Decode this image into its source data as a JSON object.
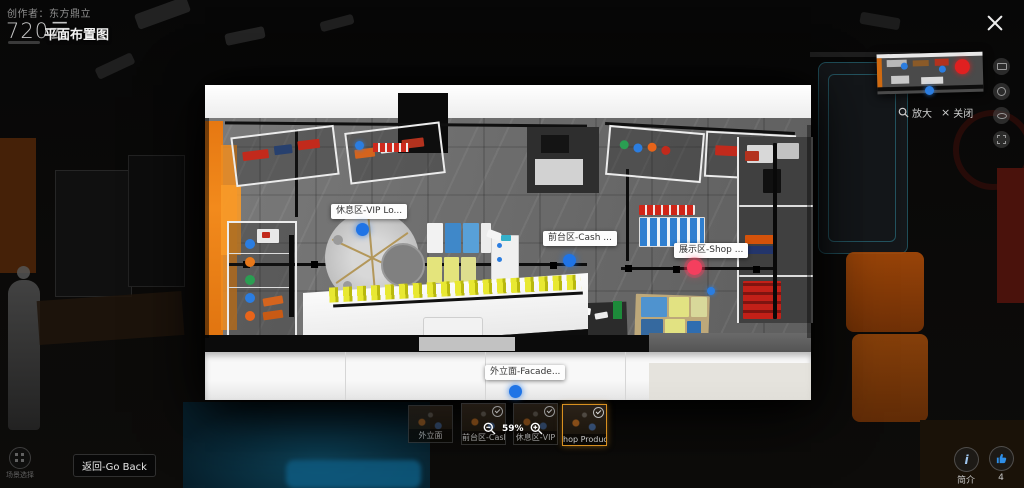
{
  "header": {
    "creator": "创作者：东方鼎立",
    "logo": "720云",
    "title": "平面布置图"
  },
  "hotspots": {
    "vip": {
      "label": "休息区-VIP Lo...",
      "color": "#1f74e6"
    },
    "cash": {
      "label": "前台区-Cash ...",
      "color": "#1f74e6"
    },
    "shop": {
      "label": "展示区-Shop ...",
      "color": "#f43f5e"
    },
    "facade": {
      "label": "外立面-Facade...",
      "color": "#1f74e6"
    }
  },
  "minimap": {
    "enlarge_label": "放大",
    "close_label": "关闭"
  },
  "zoom_control": {
    "percent": "59%"
  },
  "thumbnails": [
    {
      "label": "外立面",
      "selected": false
    },
    {
      "label": "前台区-Cash",
      "selected": false
    },
    {
      "label": "休息区-VIP",
      "selected": false
    },
    {
      "label": "hop Products",
      "selected": true
    }
  ],
  "bottom_bar": {
    "scene_select_label": "场景选择",
    "back_label": "返回-Go Back",
    "info_label": "简介",
    "like_count": "4"
  },
  "colors": {
    "accent_orange": "#ef8c1e",
    "hotspot_blue": "#1f74e6",
    "hotspot_pink": "#f43f5e",
    "selected_thumb_border": "#d89020"
  }
}
